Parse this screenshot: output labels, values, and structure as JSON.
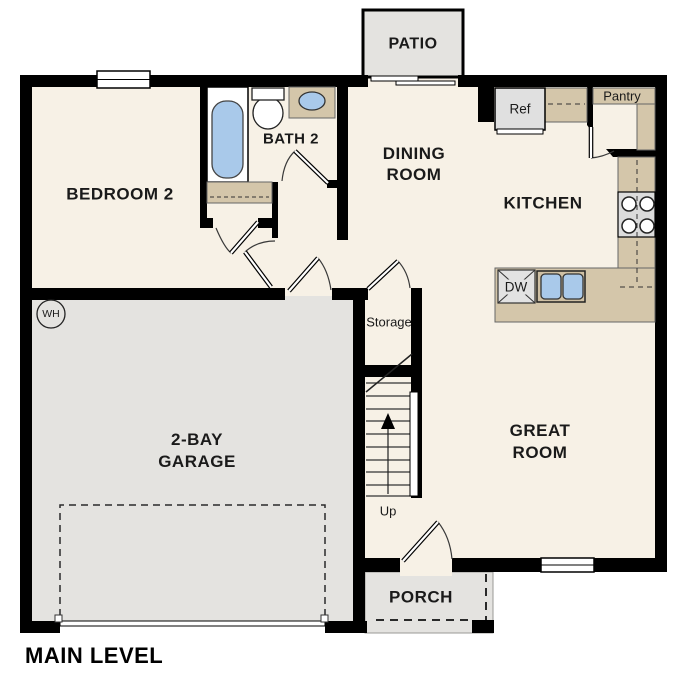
{
  "plan": {
    "title": "MAIN LEVEL",
    "rooms": {
      "patio": "PATIO",
      "dining_line1": "DINING",
      "dining_line2": "ROOM",
      "kitchen": "KITCHEN",
      "great_line1": "GREAT",
      "great_line2": "ROOM",
      "bedroom2": "BEDROOM 2",
      "bath2": "BATH 2",
      "garage_line1": "2-BAY",
      "garage_line2": "GARAGE",
      "porch": "PORCH",
      "storage": "Storage"
    },
    "annotations": {
      "pantry": "Pantry",
      "ref": "Ref",
      "dw": "DW",
      "up": "Up",
      "wh": "WH"
    },
    "colors": {
      "wall": "#000000",
      "floor": "#f7f1e6",
      "concrete": "#e4e3e0",
      "cabinet_tan": "#d4c6aa",
      "fixture_blue": "#a9c9ea",
      "appliance_gray": "#e0e0e0"
    }
  }
}
